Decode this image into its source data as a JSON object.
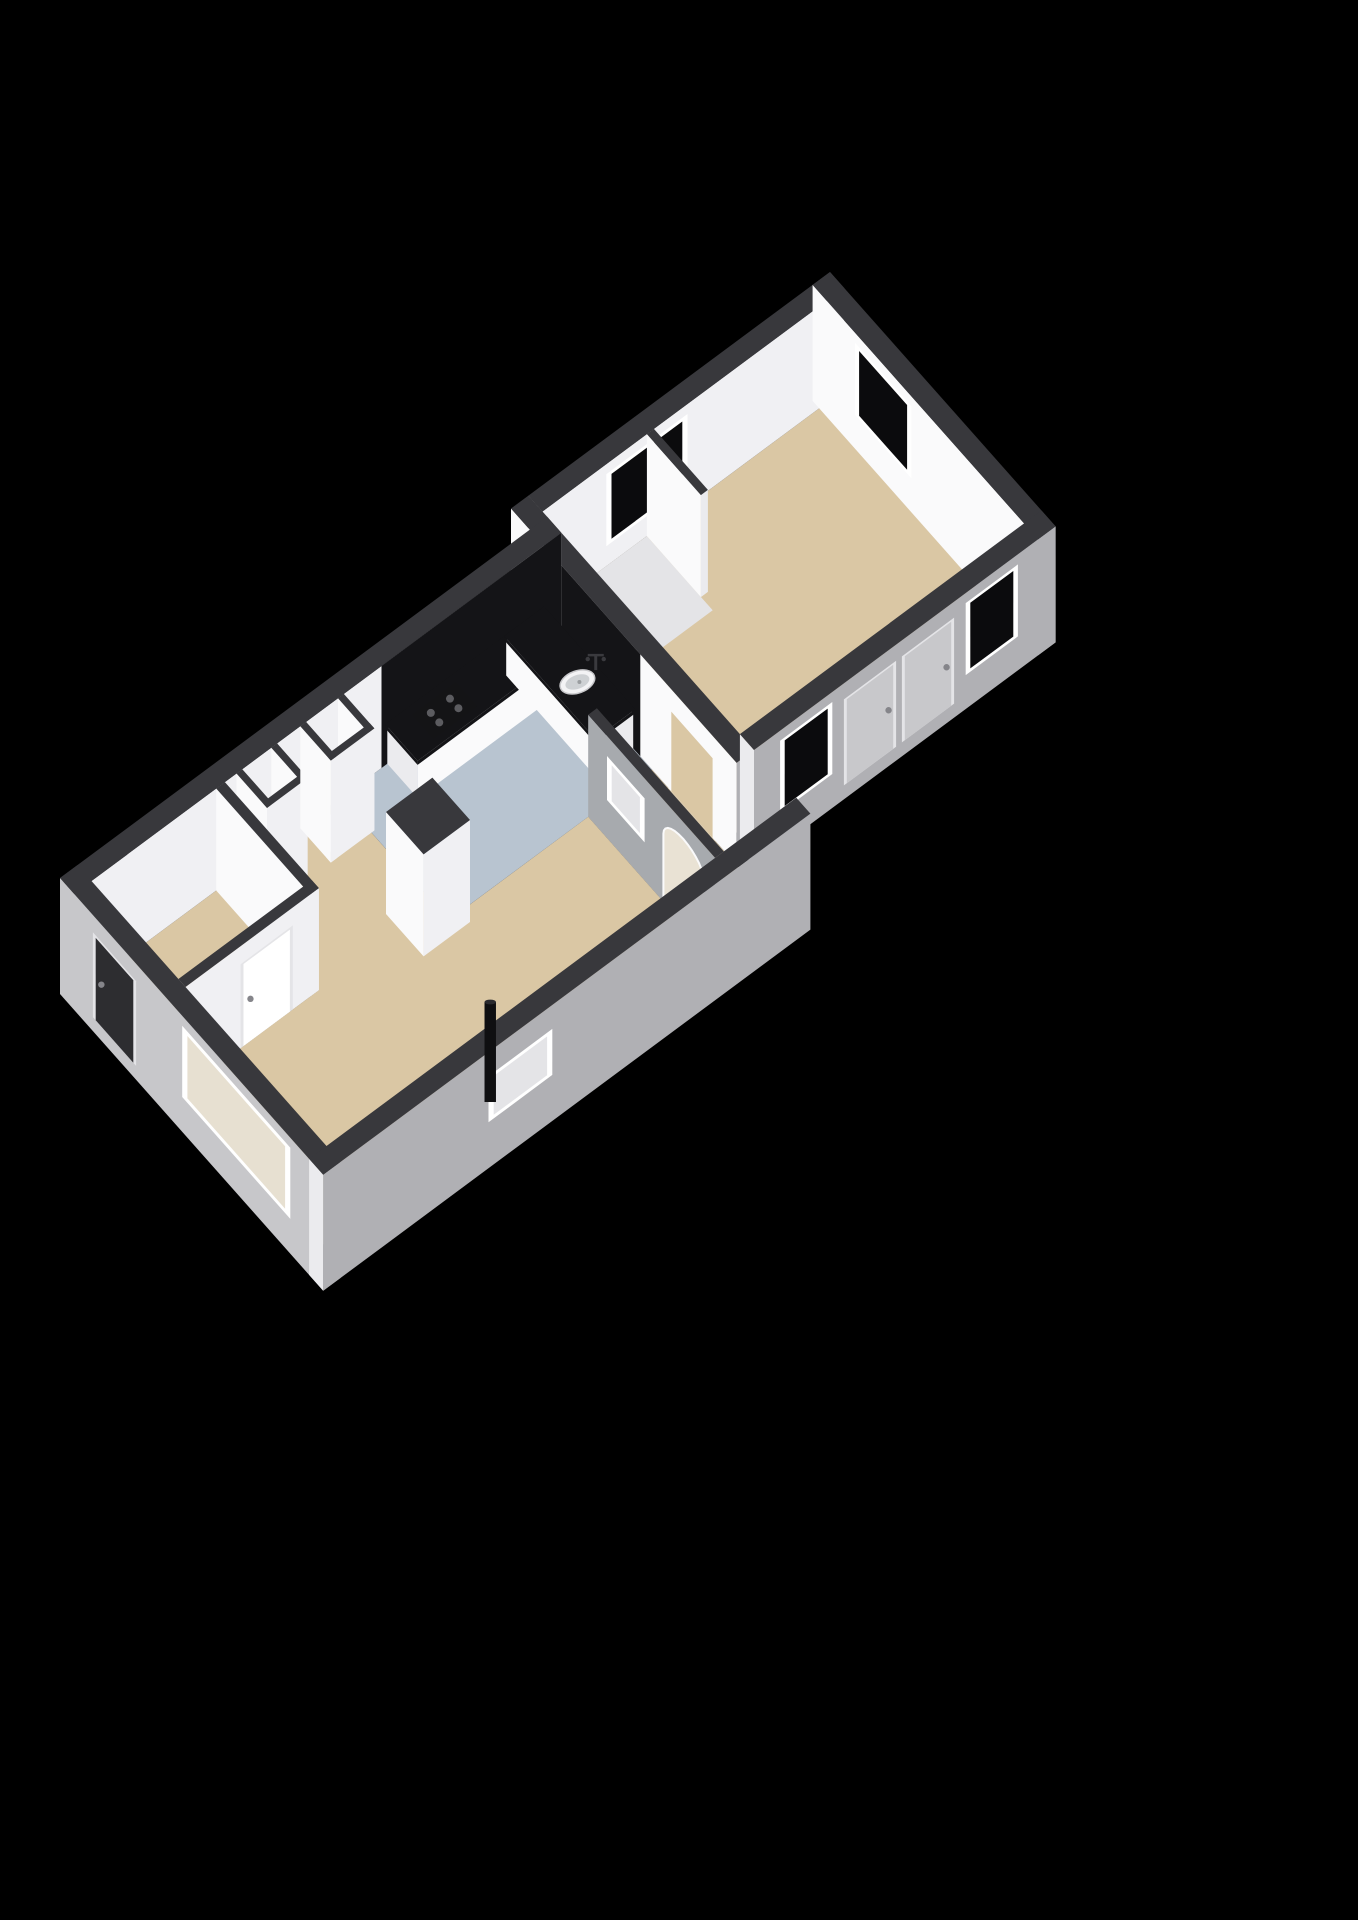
{
  "palette": {
    "bg": "#000000",
    "wallTop": "#38383c",
    "innerA": "#fafafb",
    "innerB": "#f0f0f3",
    "outerA": "#c7c7ca",
    "outerB": "#b0b0b4",
    "cap": "#ebebee",
    "black": "#141417",
    "glass": "#0b0b0d",
    "beige": "#dac7a4",
    "blue": "#b8c4d0",
    "pale": "#e4e4e7",
    "white": "#ffffff",
    "doorDark": "#2d2d30",
    "doorGray": "#c8c8cb",
    "archFill": "#e9e2d4",
    "winIn": "#e7e0d1",
    "spineGray": "#a7aaae",
    "metal": "#85858a",
    "faucet": "#3a3a3e",
    "sinkOuter": "#f3f3f5",
    "sinkInner": "#ced1d4",
    "hobBody": "#141416",
    "hobBurner": "#5c5c60",
    "pipeBody": "#0f0f11",
    "pipeTop": "#2a2a2e"
  },
  "projection": {
    "ux": [
      58,
      -43
    ],
    "vy": [
      47,
      53
    ],
    "zpx": 40,
    "origin": [
      60,
      980
    ],
    "wallH": 2.55
  },
  "scene": [
    {
      "t": "floor",
      "name": "floor-hall",
      "fill": "beige",
      "poly": [
        [
          0.3,
          0.3
        ],
        [
          2.6,
          0.3
        ],
        [
          2.6,
          2.3
        ],
        [
          0.3,
          2.3
        ]
      ]
    },
    {
      "t": "floor",
      "name": "floor-living",
      "fill": "beige",
      "poly": [
        [
          0.3,
          2.3
        ],
        [
          2.6,
          2.3
        ],
        [
          2.6,
          0.3
        ],
        [
          4.6,
          0.3
        ],
        [
          4.6,
          2.6
        ],
        [
          7.0,
          2.6
        ],
        [
          7.0,
          5.3
        ],
        [
          0.3,
          5.3
        ]
      ]
    },
    {
      "t": "floor",
      "name": "floor-kitchen",
      "fill": "blue",
      "poly": [
        [
          4.6,
          0.3
        ],
        [
          8.1,
          0.3
        ],
        [
          8.1,
          2.6
        ],
        [
          4.6,
          2.6
        ]
      ]
    },
    {
      "t": "floor",
      "name": "floor-alcove",
      "fill": "beige",
      "poly": [
        [
          7.0,
          2.6
        ],
        [
          8.1,
          2.6
        ],
        [
          8.1,
          5.3
        ],
        [
          7.0,
          5.3
        ]
      ]
    },
    {
      "t": "floor",
      "name": "floor-bedroom",
      "fill": "beige",
      "poly": [
        [
          8.4,
          -0.1
        ],
        [
          13.3,
          -0.1
        ],
        [
          13.3,
          4.1
        ],
        [
          8.4,
          4.1
        ]
      ]
    },
    {
      "t": "floor",
      "name": "floor-closet",
      "fill": "pale",
      "poly": [
        [
          8.4,
          -0.1
        ],
        [
          10.2,
          -0.1
        ],
        [
          10.2,
          1.3
        ],
        [
          8.4,
          1.3
        ]
      ]
    },
    {
      "t": "floor",
      "name": "floor-shaft-1",
      "fill": "white",
      "poly": [
        [
          2.9,
          0.4
        ],
        [
          3.4,
          0.4
        ],
        [
          3.4,
          0.85
        ],
        [
          2.9,
          0.85
        ]
      ]
    },
    {
      "t": "floor",
      "name": "floor-shaft-2",
      "fill": "white",
      "poly": [
        [
          4.0,
          0.4
        ],
        [
          4.55,
          0.4
        ],
        [
          4.55,
          0.85
        ],
        [
          4.0,
          0.85
        ]
      ]
    },
    {
      "t": "prism",
      "name": "wall-bedroom-north",
      "x": 8.4,
      "y": -0.4,
      "w": 5.2,
      "h": 0.3,
      "nx": "cap"
    },
    {
      "t": "faceRect",
      "name": "window-bedroom-north",
      "face": "py",
      "fy": -0.1,
      "u1": 9.5,
      "u2": 10.9,
      "z1": 0.5,
      "z2": 2.3,
      "frame": "white",
      "fw": 0.09,
      "fill": "glass"
    },
    {
      "t": "prism",
      "name": "wall-bedroom-east",
      "x": 13.3,
      "y": -0.4,
      "w": 0.3,
      "h": 4.8,
      "nx": "innerA",
      "py": "outerB",
      "z0": -0.35
    },
    {
      "t": "faceRect",
      "name": "window-bedroom-east",
      "face": "nx",
      "fx": 13.3,
      "u1": 0.5,
      "u2": 1.7,
      "z1": 0.5,
      "z2": 2.3,
      "frame": "white",
      "fw": 0.09,
      "fill": "glass"
    },
    {
      "t": "prism",
      "name": "wall-bedroom-closet",
      "x": 10.2,
      "y": -0.1,
      "w": 0.12,
      "h": 1.15,
      "nx": "innerA",
      "py": "cap"
    },
    {
      "t": "prism",
      "name": "wall-junction",
      "x": 8.1,
      "y": -0.4,
      "w": 0.3,
      "h": 4.8,
      "nx": "innerA",
      "py": "outerB"
    },
    {
      "t": "faceRect",
      "name": "kitchen-backsplash-east",
      "face": "nx",
      "fx": 8.1,
      "u1": 0.3,
      "u2": 2.35,
      "z1": 0,
      "z2": 2.55,
      "fill": "black"
    },
    {
      "t": "faceRect",
      "name": "doorway-bedroom",
      "face": "nx",
      "fx": 8.1,
      "u1": 2.95,
      "u2": 3.95,
      "z1": 0,
      "z2": 2.05,
      "frame": "innerA",
      "fw": 0.06,
      "fill": "beige"
    },
    {
      "t": "prism",
      "name": "wall-bedroom-south",
      "x": 8.4,
      "y": 4.1,
      "w": 5.2,
      "h": 0.3,
      "nx": "cap",
      "py": "outerB",
      "z0": -0.35
    },
    {
      "t": "faceRect",
      "name": "window-bedroom-south-1",
      "face": "py",
      "fy": 4.4,
      "u1": 8.85,
      "u2": 9.75,
      "z1": 0.5,
      "z2": 2.3,
      "frame": "white",
      "fw": 0.08,
      "fill": "glass"
    },
    {
      "t": "faceRect",
      "name": "door-bedroom-1",
      "face": "py",
      "fy": 4.4,
      "u1": 9.95,
      "u2": 10.85,
      "z1": 0,
      "z2": 2.15,
      "frame": "pale",
      "fw": 0.05,
      "fill": "doorGray",
      "handle": [
        10.72,
        1.05
      ]
    },
    {
      "t": "faceRect",
      "name": "door-bedroom-2",
      "face": "py",
      "fy": 4.4,
      "u1": 10.95,
      "u2": 11.85,
      "z1": 0,
      "z2": 2.15,
      "frame": "pale",
      "fw": 0.05,
      "fill": "doorGray",
      "handle": [
        11.72,
        1.05
      ]
    },
    {
      "t": "faceRect",
      "name": "window-bedroom-south-2",
      "face": "py",
      "fy": 4.4,
      "u1": 12.05,
      "u2": 12.95,
      "z1": 0.5,
      "z2": 2.3,
      "frame": "white",
      "fw": 0.08,
      "fill": "glass"
    },
    {
      "t": "prism",
      "name": "wall-north",
      "x": 0,
      "y": 0,
      "w": 8.4,
      "h": 0.3,
      "nx": "outerA"
    },
    {
      "t": "faceRect",
      "name": "kitchen-backsplash-north",
      "face": "py",
      "fy": 0.3,
      "u1": 5.3,
      "u2": 8.4,
      "z1": 0,
      "z2": 2.55,
      "fill": "black"
    },
    {
      "t": "prism",
      "name": "wall-shaft-1-west",
      "x": 2.8,
      "y": 0.3,
      "w": 0.1,
      "h": 0.65
    },
    {
      "t": "prism",
      "name": "wall-shaft-1-east",
      "x": 3.4,
      "y": 0.3,
      "w": 0.1,
      "h": 0.65
    },
    {
      "t": "prism",
      "name": "wall-shaft-1-south",
      "x": 2.8,
      "y": 0.85,
      "w": 0.7,
      "h": 0.1
    },
    {
      "t": "prism",
      "name": "wall-shaft-2-west",
      "x": 3.9,
      "y": 0.3,
      "w": 0.1,
      "h": 0.65
    },
    {
      "t": "prism",
      "name": "wall-shaft-2-east",
      "x": 4.55,
      "y": 0.3,
      "w": 0.1,
      "h": 0.65
    },
    {
      "t": "prism",
      "name": "wall-shaft-2-south",
      "x": 3.9,
      "y": 0.85,
      "w": 0.75,
      "h": 0.1
    },
    {
      "t": "prism",
      "name": "counter-cabinet-north",
      "x": 5.4,
      "y": 0.3,
      "w": 2.7,
      "h": 0.65,
      "z1": 0.88,
      "nx": "cap",
      "py": "innerA",
      "top": "innerA"
    },
    {
      "t": "prism",
      "name": "counter-worktop-north",
      "x": 5.38,
      "y": 0.28,
      "w": 2.74,
      "h": 0.69,
      "z0": 0.88,
      "z1": 0.98,
      "nx": "black",
      "py": "black",
      "top": "black"
    },
    {
      "t": "prism",
      "name": "counter-cabinet-east",
      "x": 7.45,
      "y": 0.3,
      "w": 0.65,
      "h": 1.9,
      "z1": 0.88,
      "nx": "innerA",
      "py": "cap",
      "top": "innerA"
    },
    {
      "t": "prism",
      "name": "counter-worktop-east",
      "x": 7.43,
      "y": 0.28,
      "w": 0.69,
      "h": 1.94,
      "z0": 0.88,
      "z1": 0.98,
      "nx": "black",
      "py": "black",
      "top": "black"
    },
    {
      "t": "hob",
      "name": "stove-hob",
      "x": 5.75,
      "y": 0.4,
      "w": 0.75,
      "h": 0.45,
      "z": 0.98
    },
    {
      "t": "sink",
      "name": "kitchen-sink",
      "x": 7.77,
      "y": 1.42,
      "z": 0.98
    },
    {
      "t": "prism",
      "name": "chimney-column",
      "x": 4.0,
      "y": 2.0,
      "w": 0.8,
      "h": 0.8
    },
    {
      "t": "prism",
      "name": "wall-divider",
      "x": 7.0,
      "y": 2.6,
      "w": 0.15,
      "h": 2.7,
      "nx": "spineGray",
      "py": "cap"
    },
    {
      "t": "faceRect",
      "name": "window-internal",
      "face": "nx",
      "fx": 7.0,
      "u1": 3.0,
      "u2": 3.8,
      "z1": 0.95,
      "z2": 2.05,
      "frame": "white",
      "fw": 0.1,
      "fill": "pale"
    },
    {
      "t": "arch",
      "name": "arch-opening",
      "fx": 7.0,
      "u1": 4.2,
      "u2": 5.05,
      "zs": 1.7,
      "fill": "archFill"
    },
    {
      "t": "prism",
      "name": "wall-hall-east",
      "x": 2.45,
      "y": 0.3,
      "w": 0.15,
      "h": 2.0,
      "nx": "innerA",
      "py": "cap"
    },
    {
      "t": "prism",
      "name": "wall-hall-south",
      "x": 0.3,
      "y": 2.15,
      "w": 2.3,
      "h": 0.15,
      "nx": "cap"
    },
    {
      "t": "faceRect",
      "name": "door-hall",
      "face": "py",
      "fy": 2.3,
      "u1": 1.25,
      "u2": 2.15,
      "z1": 0,
      "z2": 2.1,
      "frame": "pale",
      "fw": 0.05,
      "fill": "white",
      "handle": [
        1.42,
        1.05
      ]
    },
    {
      "t": "prism",
      "name": "wall-west",
      "x": 0,
      "y": 0,
      "w": 0.3,
      "h": 5.6,
      "nx": "outerA",
      "py": "outerB",
      "z0": -0.35
    },
    {
      "t": "faceRect",
      "name": "door-entrance",
      "face": "nx",
      "fx": 0,
      "u1": 0.7,
      "u2": 1.62,
      "z1": 0,
      "z2": 2.12,
      "frame": "pale",
      "fw": 0.06,
      "fill": "doorDark",
      "handle": [
        0.88,
        1.05
      ]
    },
    {
      "t": "faceRect",
      "name": "window-living",
      "face": "nx",
      "fx": 0,
      "u1": 2.6,
      "u2": 4.9,
      "z1": 0.52,
      "z2": 2.3,
      "frame": "white",
      "fw": 0.11,
      "fill": "winIn"
    },
    {
      "t": "prism",
      "name": "wall-south",
      "x": 0,
      "y": 5.3,
      "w": 8.4,
      "h": 0.3,
      "nx": "cap",
      "py": "outerB",
      "z0": -0.35
    },
    {
      "t": "faceRect",
      "name": "niche-window",
      "face": "py",
      "fy": 5.6,
      "u1": 2.85,
      "u2": 3.95,
      "z1": 0.8,
      "z2": 1.95,
      "frame": "white",
      "fw": 0.09,
      "fill": "pale"
    },
    {
      "t": "pipe",
      "name": "stove-flue-pipe",
      "x": 3.35,
      "y": 5.02,
      "r": 0.11,
      "h": 2.5
    }
  ]
}
